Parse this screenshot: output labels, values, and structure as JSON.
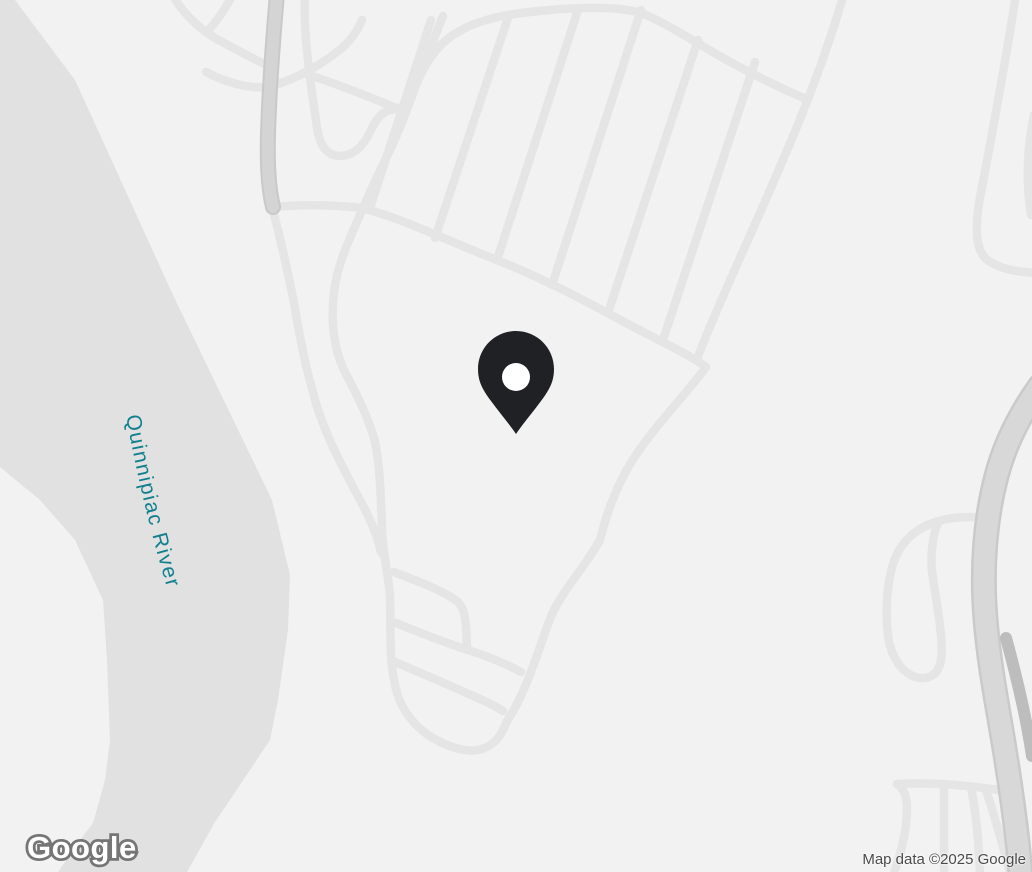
{
  "map": {
    "provider": "Google",
    "labels": {
      "water_label": "Quinnipiac River"
    },
    "marker": {
      "name": "location-pin"
    },
    "watermark_logo": "Google",
    "attribution": "Map data ©2025 Google",
    "colors": {
      "land": "#f2f2f2",
      "water": "#e1e1e1",
      "road-minor": "#e5e5e5",
      "road-major-fill": "#d4d4d4",
      "road-major-casing": "#c9c9c9",
      "road-highway-fill": "#d8d8d8",
      "road-highway-casing": "#cacaca",
      "ramp": "#bdbdbd",
      "pin": "#202125",
      "water-label-text": "#10808f",
      "attribution-text": "#4a4a4a",
      "logo-outline": "#757575"
    }
  }
}
